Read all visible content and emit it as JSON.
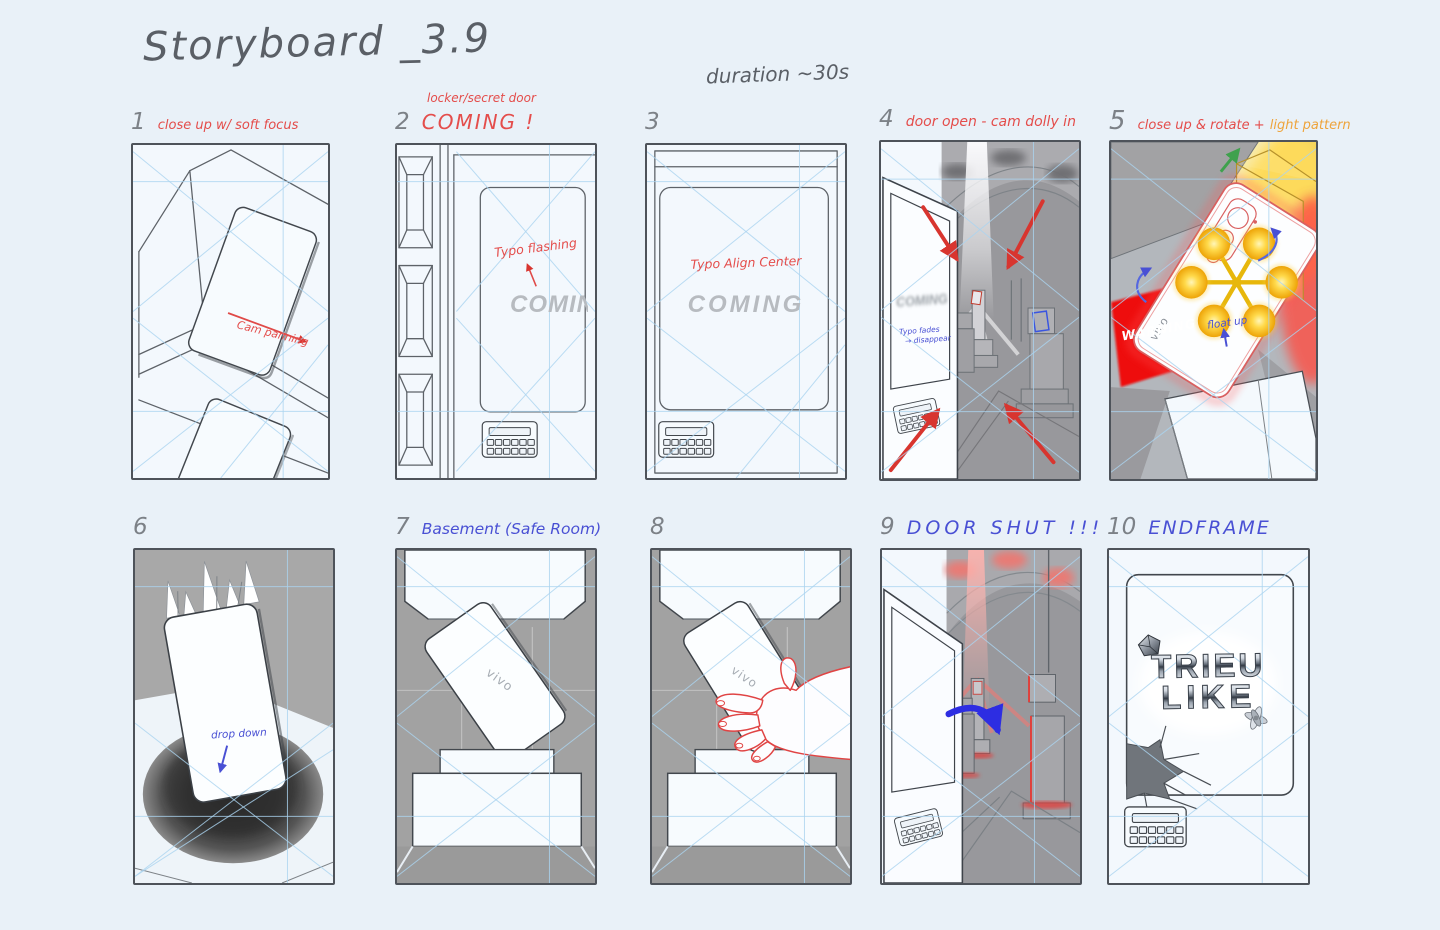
{
  "header": {
    "title": "Storyboard _3.9",
    "duration": "duration ~30s"
  },
  "colors": {
    "background": "#e9f1f8",
    "sketch_ink": "#5d6268",
    "guide_blue": "#abd4f0",
    "note_red": "#e44d4b",
    "note_orange": "#eea43c",
    "note_blue": "#4950d4",
    "corridor_gray": "#98989c",
    "warning_red": "#ee1010",
    "orb_yellow": "#ffd94a"
  },
  "frames": [
    {
      "number": "1",
      "label": "close up w/ soft focus",
      "cam_note": "Cam panning"
    },
    {
      "number": "2",
      "toplabel": "locker/secret door",
      "label": "COMING !",
      "typo_note": "Typo flashing",
      "coming_text": "COMING"
    },
    {
      "number": "3",
      "typo_note": "Typo Align Center",
      "coming_text": "COMING"
    },
    {
      "number": "4",
      "label": "door open - cam dolly in",
      "coming_text": "COMING",
      "fade_note": "Typo fades",
      "fade_note2": "→ disappear"
    },
    {
      "number": "5",
      "label": "close up & rotate +",
      "label2": "light pattern",
      "warning": "WARNING",
      "float_note": "float up",
      "brand": "vivo"
    },
    {
      "number": "6",
      "drop_note": "drop down"
    },
    {
      "number": "7",
      "label": "Basement (Safe Room)",
      "brand": "vivo"
    },
    {
      "number": "8",
      "brand": "vivo"
    },
    {
      "number": "9",
      "label": "DOOR SHUT !!!"
    },
    {
      "number": "10",
      "label": "ENDFRAME",
      "logo_line1": "TRIEU",
      "logo_line2": "LIKE"
    }
  ]
}
